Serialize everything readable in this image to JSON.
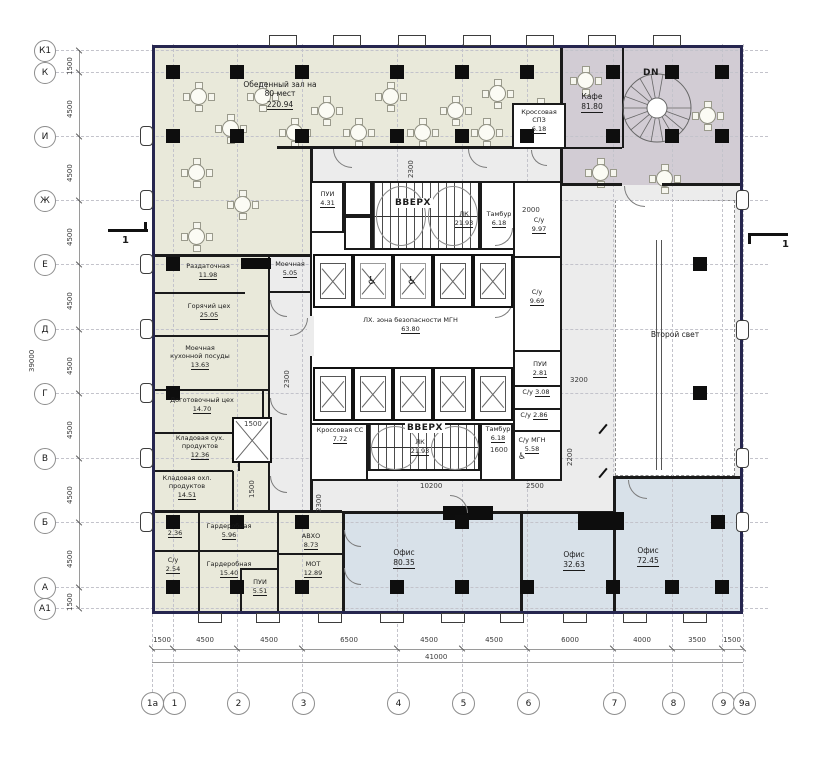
{
  "colors": {
    "wall_exterior": "#26264f",
    "wall_interior": "#1a1a1a",
    "kitchen_tint": "#e9e9da",
    "cafe_tint": "#d2ccd4",
    "office_tint": "#d8e1e9",
    "corridor_tint": "#ececec"
  },
  "grid": {
    "rows": [
      {
        "label": "К1"
      },
      {
        "label": "К"
      },
      {
        "label": "И"
      },
      {
        "label": "Ж"
      },
      {
        "label": "Е"
      },
      {
        "label": "Д"
      },
      {
        "label": "Г"
      },
      {
        "label": "В"
      },
      {
        "label": "Б"
      },
      {
        "label": "А"
      },
      {
        "label": "А1"
      }
    ],
    "row_dims": [
      "1500",
      "4500",
      "4500",
      "4500",
      "4500",
      "4500",
      "4500",
      "4500",
      "4500",
      "1500"
    ],
    "row_total": "39000",
    "cols": [
      {
        "label": "1а"
      },
      {
        "label": "1"
      },
      {
        "label": "2"
      },
      {
        "label": "3"
      },
      {
        "label": "4"
      },
      {
        "label": "5"
      },
      {
        "label": "6"
      },
      {
        "label": "7"
      },
      {
        "label": "8"
      },
      {
        "label": "9"
      },
      {
        "label": "9а"
      }
    ],
    "col_dims": [
      "1500",
      "4500",
      "4500",
      "6500",
      "4500",
      "4500",
      "6000",
      "4000",
      "3500",
      "1500"
    ],
    "col_total": "41000"
  },
  "rooms": {
    "dining": {
      "name": "Обеденный зал на 80 мест",
      "area": "220.94"
    },
    "cafe": {
      "name": "Кафе",
      "area": "81.80"
    },
    "cross_sp3": {
      "name": "Кроссовая СПЗ",
      "area": "6.18"
    },
    "razdat": {
      "name": "Раздаточная",
      "area": "11.98"
    },
    "moechnaya": {
      "name": "Моечная",
      "area": "5.05"
    },
    "hot": {
      "name": "Горячий цех",
      "area": "25.05"
    },
    "wash": {
      "name": "Моечная кухонной посуды",
      "area": "13.63"
    },
    "dogot": {
      "name": "Доготовочный цех",
      "area": "14.70"
    },
    "dry": {
      "name": "Кладовая сух. продуктов",
      "area": "12.36"
    },
    "cold": {
      "name": "Кладовая охл. продуктов",
      "area": "14.51"
    },
    "su236": {
      "name": "С/у",
      "area": "2.36"
    },
    "ward1": {
      "name": "Гардеробная",
      "area": "5.96"
    },
    "su254": {
      "name": "С/у",
      "area": "2.54"
    },
    "ward2": {
      "name": "Гардеробная",
      "area": "15.40"
    },
    "pui551": {
      "name": "ПУИ",
      "area": "5.51"
    },
    "avho": {
      "name": "АВХО",
      "area": "8.73"
    },
    "mot": {
      "name": "МОТ",
      "area": "12.89"
    },
    "pui431": {
      "name": "ПУИ",
      "area": "4.31"
    },
    "lk_top": {
      "name": "ЛК",
      "area": "21.93"
    },
    "tambur_top": {
      "name": "Тамбур",
      "area": "6.18"
    },
    "lobby": {
      "name": "ЛХ. зона безопасности МГН",
      "area": "63.80"
    },
    "su997": {
      "name": "С/у",
      "area": "9.97"
    },
    "su969": {
      "name": "С/у",
      "area": "9.69"
    },
    "pui281": {
      "name": "ПУИ",
      "area": "2.81"
    },
    "su308": {
      "name": "С/у",
      "area": "3.08"
    },
    "su286": {
      "name": "С/у",
      "area": "2.86"
    },
    "sumgn": {
      "name": "С/у МГН",
      "area": "5.58"
    },
    "cross_cc": {
      "name": "Кроссовая СС",
      "area": "7.72"
    },
    "lk_bot": {
      "name": "ЛК",
      "area": "21.93"
    },
    "tambur_bot": {
      "name": "Тамбур",
      "area": "6.18"
    },
    "office1": {
      "name": "Офис",
      "area": "80.35"
    },
    "office2": {
      "name": "Офис",
      "area": "32.63"
    },
    "office3": {
      "name": "Офис",
      "area": "72.45"
    },
    "second_light": {
      "name": "Второй свет"
    }
  },
  "annotations": {
    "up": "ВВЕРХ",
    "dn": "DN",
    "section": "1",
    "dims": {
      "c2300a": "2300",
      "c2300b": "2300",
      "c2300c": "2300",
      "c2000": "2000",
      "c3200": "3200",
      "c2200": "2200",
      "c2500": "2500",
      "c10200": "10200",
      "c1500a": "1500",
      "c1500b": "1500",
      "c1600": "1600"
    }
  }
}
